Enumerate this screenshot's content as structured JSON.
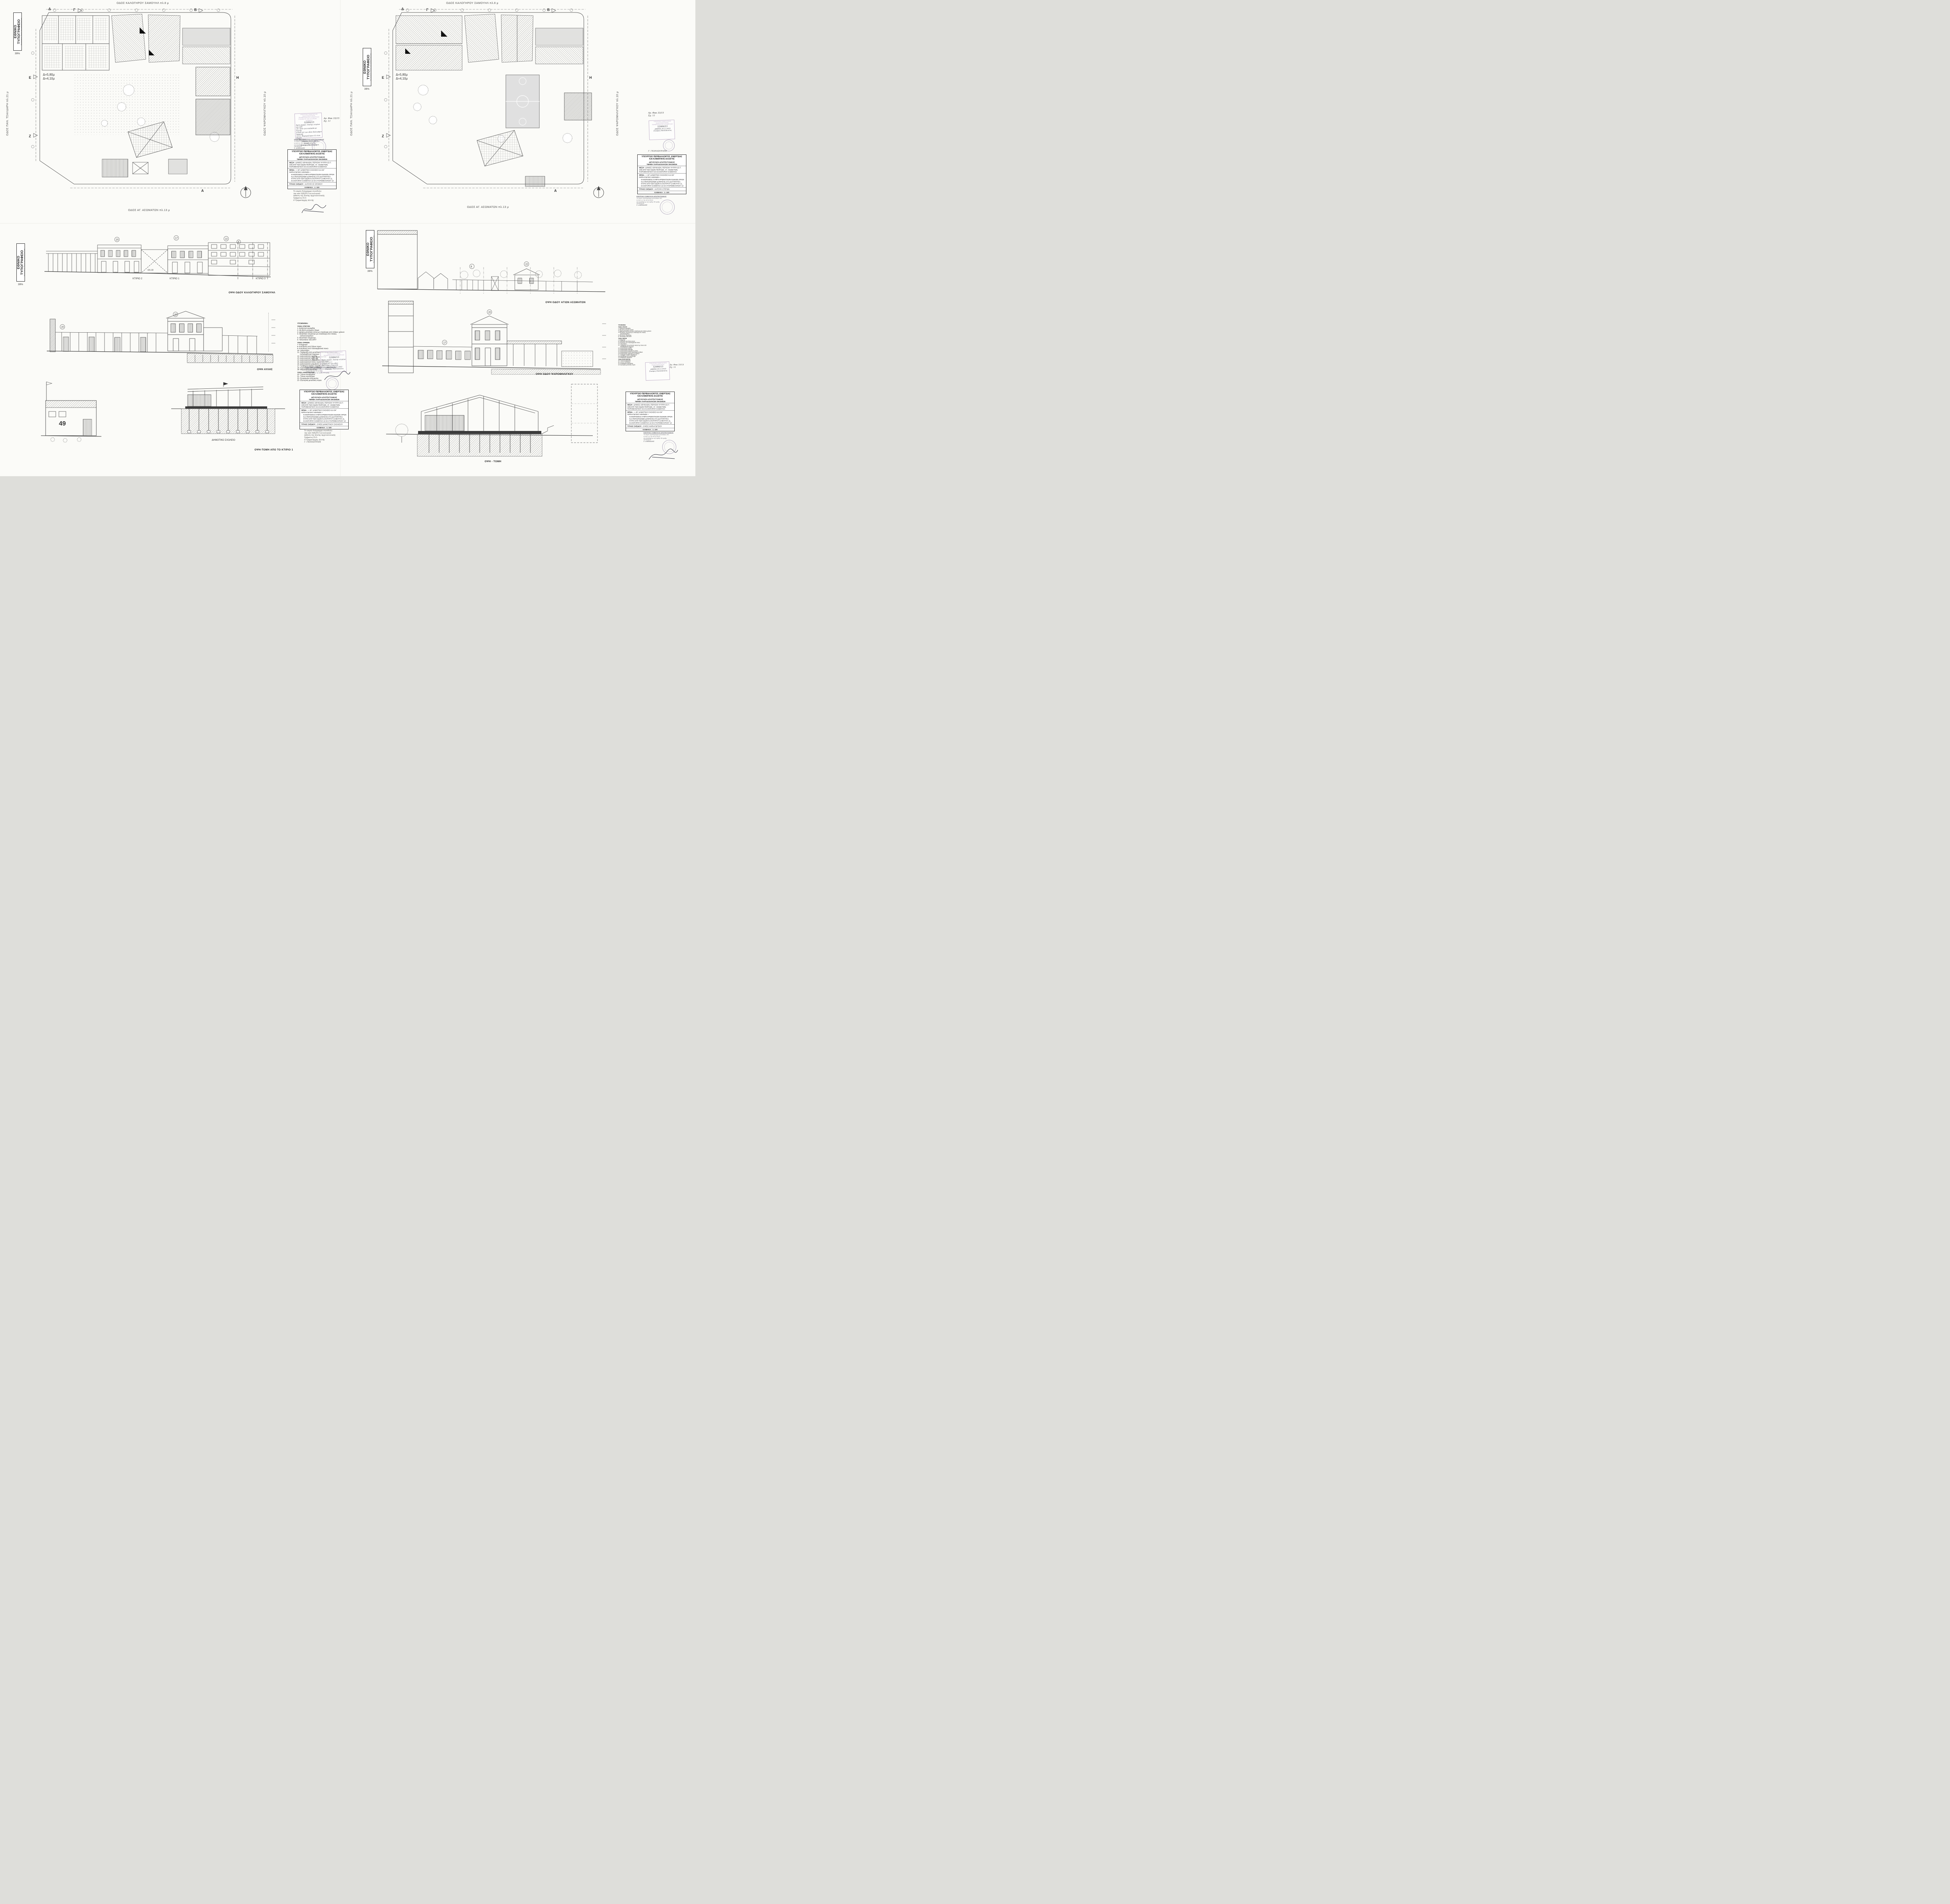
{
  "titleblock": {
    "ministry1": "ΥΠΟΥΡΓΕΙΟ ΠΕΡΙΒΑΛΛΟΝΤΟΣ, ΕΝΕΡΓΕΙΑΣ",
    "ministry2": "ΚΑΙ ΚΛΙΜΑΤΙΚΗΣ ΑΛΛΑΓΗΣ",
    "dept1": "ΔΙΕΥΘΥΝΣΗ ΑΡΧΙΤΕΚΤΟΝΙΚΗΣ",
    "dept2": "ΤΜΗΜΑ ΠΑΡΑΔΟΣΙΑΚΩΝ ΟΙΚΙΣΜΩΝ",
    "thesi_label": "ΘΕΣΗ :",
    "thesi_text": "ΔΗΜΟΣ ΑΘΗΝΑΙΩΝ, ΠΕΡΙΟΧΗ ΨΥΡΡΗ (Ο.Τ. 100) ΕΠΙ ΤΩΝ ΟΔΩΝ ΠΕΙΡΑΙΩΣ, ΑΓ. ΑΣΩΜΑΤΩΝ, ΨΑΡΟΜΗΛΙΓΚΟΥ ΚΑΙ ΚΑΛΟΓΗΡΟΥ ΣΑΜΟΥΗΛ",
    "thema_label": "ΘΕΜΑ :",
    "thema_quote": "« 49° ΔΗΜΟΤΙΚΟ ΣΧΟΛΕΙΟ ΚΑΙ 84° ΝΗΠΙΑΓΩΓΕΙΟ ΑΘΗΝΩΝ »",
    "thema_text": "ΚΑΘΟΡΙΣΜΟΣ ΣΥΜΠΛΗΡΩΜΑΤΙΚΩΝ ΕΙΔΙΚΩΝ ΟΡΩΝ ΚΑΙ ΠΕΡΙΟΡΙΣΜΩΝ ΔΟΜΗΣΗΣ ΣΤΑ ΔΙΑΤΗΡΗΤΕΑ ΚΤΙΡΙΑ ΕΠΙ ΤΩΝ ΟΔΩΝ ΚΑΛΟΓΗΡΟΥ ΣΑΜΟΥΗΛ 11, ΚΑΛΟΓΗΡΟΥ ΣΑΜΟΥΗΛ 13 ΚΑΙ ΨΑΡΟΜΗΛΙΓΚΟΥ 12",
    "titlos_label": "ΤΙΤΛΟΣ ΣΧΕΔΙΟΥ :",
    "klimaka_label": "ΚΛΙΜΑΚΑ :",
    "klimaka_value": "1: 100"
  },
  "sheets": {
    "tl": {
      "title": "ΚΑΤΟΨΗ Β' ΟΡΟΦΟΥ"
    },
    "tr": {
      "title": "ΚΑΤΟΨΗ ΣΤΕΓΩΝ"
    },
    "bl": {
      "title": "ΟΨΕΙΣ ΔΗΜΟΤΙΚΟΥ ΣΧΟΛΕΙΟΥ"
    },
    "br": {
      "title": "ΟΨΕΙΣ ΝΗΠΙΑΓΩΓΕΙΟΥ"
    }
  },
  "streets": {
    "top": "ΟΔΟΣ ΚΑΛΟΓΗΡΟΥ ΣΑΜΟΥΗΛ πλ.8 μ",
    "bottom": "ΟΔΟΣ ΑΓ. ΑΣΩΜΑΤΩΝ πλ.13 μ",
    "left": "ΟΔΟΣ ΠΑΝ. ΤΣΑΛΔΑΡΗ πλ.21 μ",
    "right": "ΟΔΟΣ ΨΑΡΟΜΗΛΙΓΚΟΥ πλ.10 μ"
  },
  "press": {
    "title": "ΕΘΝΙΚΟ ΤΥΠΟΓΡΑΦΕΙΟ",
    "sub": "Για τεχνικούς λόγους στα σχεδιαγράμματα",
    "pct": "39%"
  },
  "legend": {
    "title": "ΥΠΟΜΝΗΜΑ:",
    "g1_title": "ΥΛΙΚΑ ΣΤΕΓΩΝ",
    "g1": [
      "1-  Βυζαντινά κεραμίδια",
      "2-  Μη βατό μονωμένο δώμα",
      "3-  Δίριχτη μεταλλική στέγη με επικάλυψη από πλάκες χαλκού",
      "4-  Μεταλλικό στέγαστρο με επικάλυψη από πλάκες υαλοπετασμάτων",
      "5-  Μεταλλικό στέγαστρο",
      "6-  Υαλοστάσιο SECURIT"
    ],
    "g2_title": "ΥΛΙΚΑ ΟΨΕΩΝ",
    "g2": [
      "7-  Επίχρισμα",
      "8-  Επένδυση από ξύλινα πανώ",
      "9-  Επένδυση από πολυκαρβονικά πανώ",
      "10- Υαλοστάσιο",
      "11- Περίφραξη από μεταλλικό σκελετό με πανώ από πολυκαρβονικό έγχρωμο",
      "12- Διακοσμητική κορνίζα",
      "13- Διακοσμητικά τρίγλυφα",
      "14- Διακοσμητικοί μαρμάρινες κίονες",
      "15- Διακοσμητικοί κίονες κορινθιακού ρυθμού",
      "16- Διακοσμητικό μαρμάρινο υπέρθυρο",
      "17- Τραβηχτό πλαίσιο παράθυρων",
      "18- Κιγκλίδωμα από χυτοσίδηρο",
      "19- Μαρμάρινα φορούσια"
    ],
    "g3_title": "ΥΛΙΚΑ ΑΝΟΙΓΜΑΤΩΝ",
    "g3": [
      "20- Ξύλινα κουφώματα",
      "21- Ξύλινα παντζούρια",
      "22- Κουφώματα αλουμινίου",
      "23- Εξωτερική μεταλλική πόρτα"
    ]
  },
  "stamp": {
    "header1": "ΥΠΟΥΡΓΕΙΟ ΠΑΡΑΓΩΓΙΚΗΣ ΑΝΑΣΥΓΚΡΟΤΗΣΗΣ,",
    "header2": "ΠΕΡΙΒΑΛΛΟΝΤΟΣ & ΕΝΕΡΓΕΙΑΣ",
    "header3": "ΣΥΝΟΔΕΥΕΙ ΤΗΝ ΥΠ' ΑΡΙΘΜ. ...... ΑΠΟΦΑΣΗ",
    "number": "52006/15",
    "line1": "Άρση χαρακτ. διατηρ. κτιρίων και καθ.",
    "line2": "ειδ. όρων για οικόπεδα με διατηρ.",
    "line3": "κτίρια επί των οδών Καλογήρου Σαμουήλ",
    "line4": "13-11, Ψαρομηλίγκου 12 στου Ψυρρή",
    "line5": "Δ. Αθηνών",
    "date": "ΑΘΗΝΑ 30-11-2015",
    "role": "Αναπλ. Δ/ντής",
    "sig": "Σταύρος Παυλόπουλος"
  },
  "refs": {
    "file_no": "Αρ. Φακ 33/15",
    "sheet_no": "Σχ. 11"
  },
  "kesa": {
    "title": "ΚΕΝΤΡΙΚΟ ΣΥΜΒΟΥΛΙΟ ΑΡΧΙΤΕΚΤΟΝΙΚΗΣ",
    "line1": "Το παρόν σχεδιάγραμμα μελετήθηκε από",
    "line2": "το ΚΕ.Σ.Α. την 04-12-2013",
    "line3": "και εγκρίθηκε με την αριθμ. 89 πράξη",
    "proedros": "ΠΡΟΕΔΡΟΣ",
    "name": "Σ. ΑΛΕΞΙΑΔΗΣ"
  },
  "note": {
    "line1": "Το παρόν διάγραμμα συνοδεύει",
    "line2": "την από 5|9|2013 αιτιολογική",
    "line3": "έκθεση της Δ/νσης Αρχιτεκτονικής",
    "line4": "Τμήματος Π.Ο.",
    "line5": "Ο Τμηματάρχης    Δ/ντής",
    "signer": "Γ. ΓΚΑΝΑΣΟΥΛΗΣ"
  },
  "plan": {
    "delta1": "Δ=5,80μ",
    "delta2": "Δ=4,10μ",
    "gamma": "Γ",
    "beta": "Β",
    "epsilon": "Ε",
    "zeta": "Ζ",
    "eta": "Η",
    "alpha": "Α",
    "delta": "Δ"
  },
  "elev": {
    "k101": "101.33",
    "num49": "49",
    "dimotiko": "ΔΗΜΟΤΙΚΟ ΣΧΟΛΕΙΟ",
    "ktirio1": "ΚΤΙΡΙΟ 1",
    "ktirio2": "ΚΤΙΡΙΟ 2",
    "ktirio3": "ΚΤΙΡΙΟ 3",
    "m8": "8",
    "m17": "17",
    "m20": "20",
    "m22": "22"
  },
  "captions": {
    "bl1": "ΟΨΗ ΟΔΟΥ ΚΑΛΟΓΗΡΟΥ ΣΑΜΟΥΗΛ",
    "bl2": "ΟΨΗ ΑΥΛΗΣ",
    "bl3": "ΟΨΗ-ΤΟΜΗ ΑΠΟ ΤΟ ΚΤΙΡΙΟ 1",
    "br1": "ΟΨΗ ΟΔΟΥ ΑΓΙΩΝ ΑΣΩΜΑΤΩΝ",
    "br2": "ΟΨΗ ΟΔΟΥ ΨΑΡΟΜΗΛΙΓΚΟΥ",
    "br3": "ΟΨΗ - ΤΟΜΗ"
  }
}
